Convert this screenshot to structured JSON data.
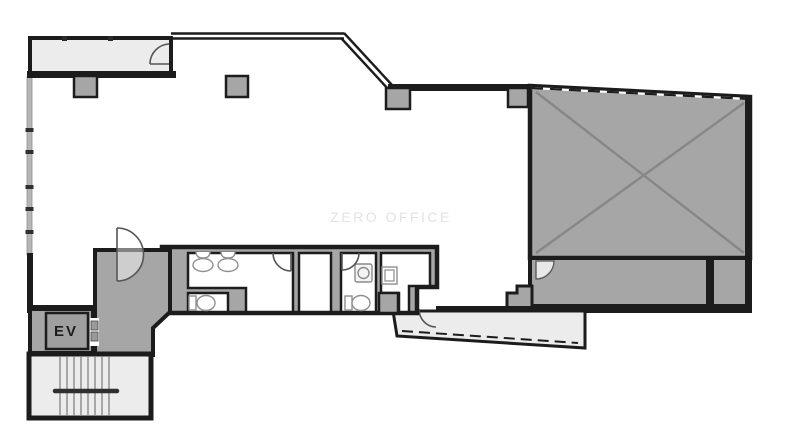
{
  "plan": {
    "watermark": "ZERO OFFICE",
    "elevator": {
      "label": "EV"
    }
  },
  "colors": {
    "wall": "#1c1c1c",
    "room_fill_gray": "#a6a6a6",
    "room_fill_light": "#ececec",
    "x_mark": "#878787",
    "watermark_text": "#e3e3e3"
  },
  "icons": {
    "doors": "door-swing-icon",
    "sinks": "sink-icon",
    "toilets": "toilet-icon",
    "stairs": "stair-treads",
    "void": "x-cross-mark"
  }
}
